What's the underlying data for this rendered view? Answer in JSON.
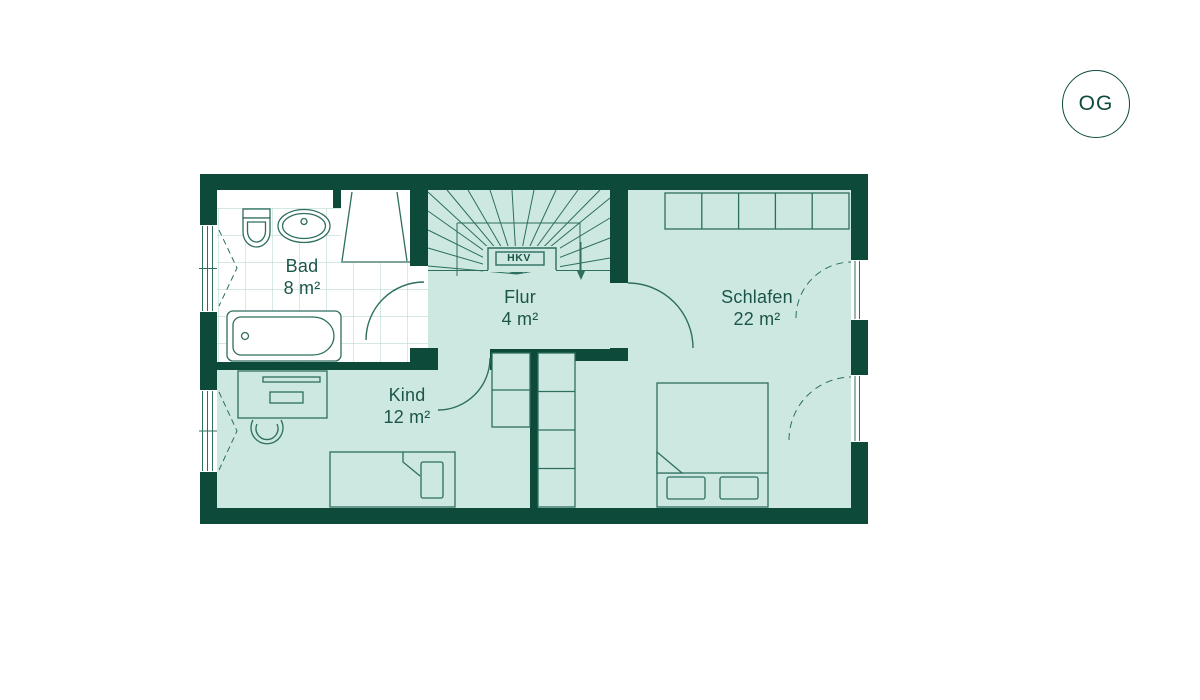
{
  "badge": {
    "label": "OG"
  },
  "plan": {
    "rooms": [
      {
        "key": "bad",
        "name": "Bad",
        "area": "8 m²"
      },
      {
        "key": "flur",
        "name": "Flur",
        "area": "4 m²"
      },
      {
        "key": "schlafen",
        "name": "Schlafen",
        "area": "22 m²"
      },
      {
        "key": "kind",
        "name": "Kind",
        "area": "12 m²"
      }
    ],
    "labels": {
      "hkv": "HKV"
    },
    "colors": {
      "wall": "#0e4a39",
      "floor": "#cde8e0",
      "line": "#2d6e5f",
      "tile": "#b9dcd2",
      "text": "#1b554a"
    }
  }
}
